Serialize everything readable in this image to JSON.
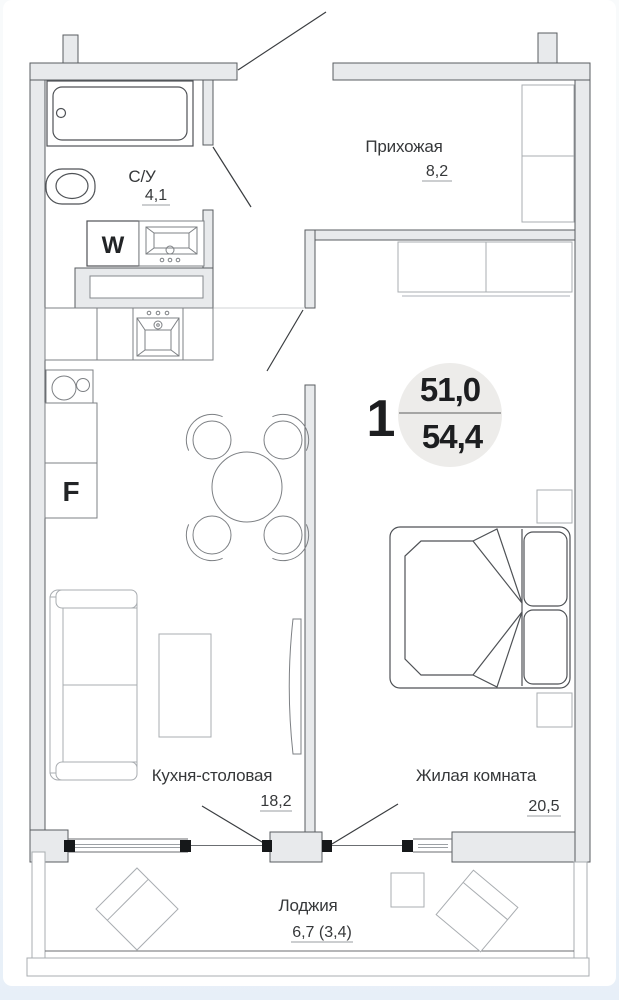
{
  "plan": {
    "badge": {
      "number": "1",
      "area_main": "51,0",
      "area_total": "54,4"
    },
    "rooms": [
      {
        "name": "С/У",
        "area": "4,1"
      },
      {
        "name": "Прихожая",
        "area": "8,2"
      },
      {
        "name": "Кухня-столовая",
        "area": "18,2"
      },
      {
        "name": "Жилая комната",
        "area": "20,5"
      },
      {
        "name": "Лоджия",
        "area": "6,7 (3,4)"
      }
    ],
    "appliances": {
      "washer_label": "W",
      "fridge_label": "F"
    },
    "colors": {
      "wall_fill": "#e8eaec",
      "wall_edge": "#595c60",
      "badge_circle": "#edecea",
      "page_bottom": "#e7eff8",
      "text": "#36383a"
    }
  }
}
